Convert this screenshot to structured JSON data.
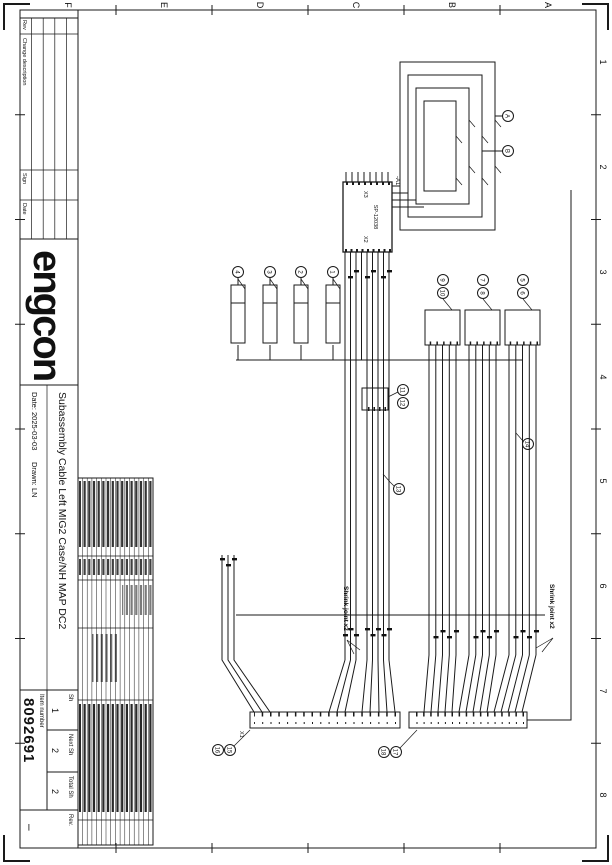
{
  "frame": {
    "letters": [
      "A",
      "B",
      "C",
      "D",
      "E",
      "F"
    ],
    "numbers": [
      "1",
      "2",
      "3",
      "4",
      "5",
      "6",
      "7",
      "8"
    ]
  },
  "revision_table": {
    "headers": [
      "Rev",
      "Change description",
      "Sign",
      "Date"
    ]
  },
  "title_block": {
    "logo": "engcon",
    "title": "Subassembly Cable Left MIG2 Case/NH MAP DC2",
    "date_label": "Date:",
    "date": "2025-03-03",
    "drawn_label": "Drawn:",
    "drawn": "LN",
    "item_label": "Item number",
    "item_number": "8092691",
    "sh_label": "Sh",
    "sh_value": "1",
    "next_label": "Next Sh",
    "next_value": "2",
    "total_label": "Total Sh",
    "total_value": "2",
    "rev_label": "Rev.",
    "rev_value": "–"
  },
  "schematic": {
    "device": "-A1",
    "device_part": "SP-12038",
    "conn_left": "X3",
    "conn_right": "X2",
    "strip1_label": "X1",
    "shrink_joint": "Shrink joint x2",
    "refs": {
      "t1": "A",
      "t2": "B",
      "valves": [
        "1",
        "2",
        "3",
        "4"
      ],
      "boxes": [
        [
          "5",
          "6"
        ],
        [
          "7",
          "8"
        ],
        [
          "9",
          "10"
        ]
      ],
      "cconn": [
        "11",
        "12"
      ],
      "tap1": "13",
      "tap2": "14",
      "strip1": [
        "15",
        "16"
      ],
      "strip2": [
        "17",
        "18"
      ]
    }
  },
  "colors": {
    "ink": "#1a1a1a",
    "paper": "#ffffff"
  }
}
